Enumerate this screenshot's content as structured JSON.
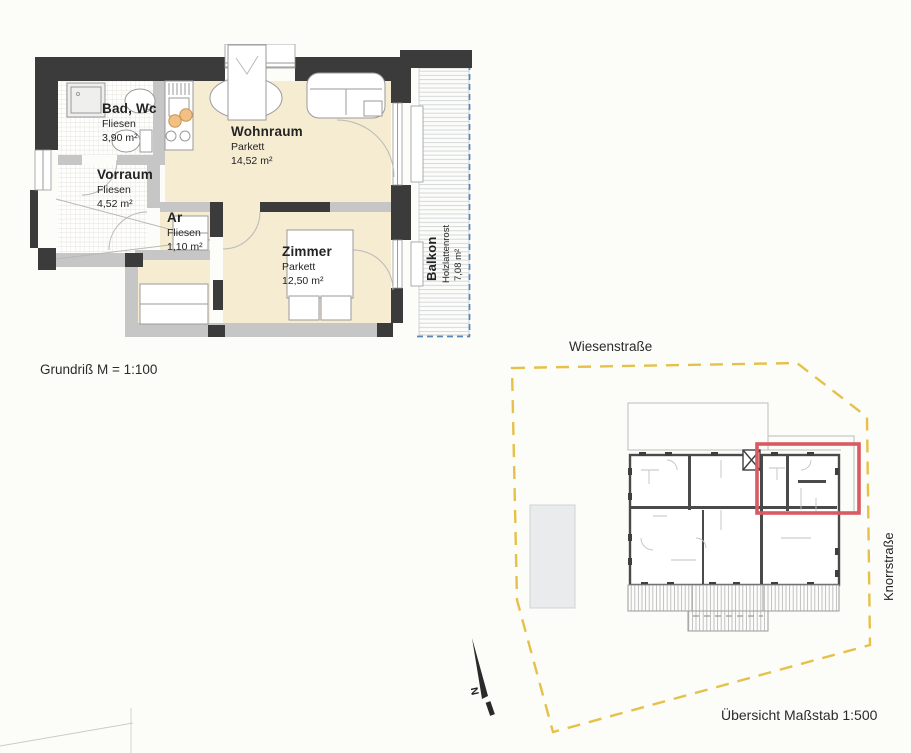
{
  "document": {
    "plan_caption": "Grundriß M = 1:100",
    "overview_caption": "Übersicht Maßstab 1:500"
  },
  "floor_plan": {
    "rooms": [
      {
        "name": "Bad, Wc",
        "floor": "Fliesen",
        "area": "3,90 m²"
      },
      {
        "name": "Vorraum",
        "floor": "Fliesen",
        "area": "4,52 m²"
      },
      {
        "name": "Ar",
        "floor": "Fliesen",
        "area": "1,10 m²"
      },
      {
        "name": "Wohnraum",
        "floor": "Parkett",
        "area": "14,52 m²"
      },
      {
        "name": "Zimmer",
        "floor": "Parkett",
        "area": "12,50 m²"
      },
      {
        "name": "Balkon",
        "floor": "Holzlattenrost",
        "area": "7,08 m²"
      }
    ]
  },
  "site_plan": {
    "street_top": "Wiesenstraße",
    "street_right": "Knorrstraße",
    "north_label": "N"
  },
  "colors": {
    "wall_dark": "#3b3b3b",
    "wall_light": "#c6c6c6",
    "room_parquet": "#f5ecd2",
    "balcony_dash": "#5b87b5",
    "boundary_dash": "#e6c14a",
    "highlight_red": "#d95a62"
  }
}
